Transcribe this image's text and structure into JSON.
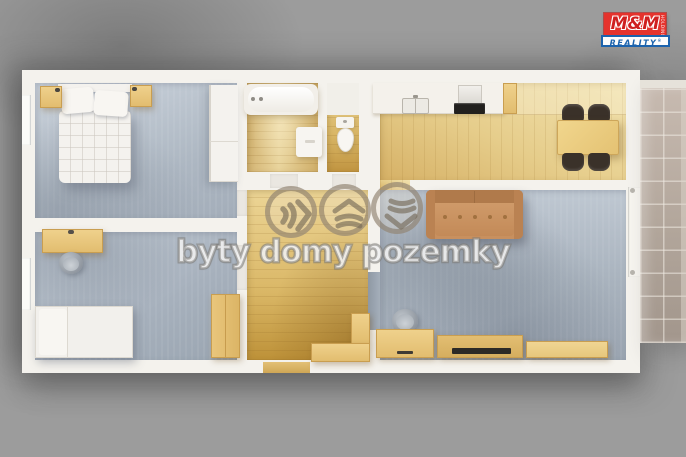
{
  "watermark": {
    "text": "byty domy pozemky",
    "icons": [
      "chevrons-right",
      "chevrons-up",
      "chevrons-down"
    ],
    "overlay_color": "rgba(238,228,208,0.3)"
  },
  "logo": {
    "top": "M&M",
    "holding": "HOLDING",
    "bottom": "REALITY",
    "reg": "®",
    "brand_red": "#e5332d",
    "brand_blue": "#1c63ad"
  },
  "palette": {
    "background": "#9b9b9b",
    "wall": "#f4f2ed",
    "wood_floor_light": "#ecd9a2",
    "wood_floor_dark": "#c49b45",
    "carpet_blue_gray": "#b4bec9",
    "balcony_tile": "#b3a69b",
    "sofa_brown": "#c8905f",
    "furniture_wood": "#e8c77e",
    "dark_chair": "#3a3129"
  }
}
